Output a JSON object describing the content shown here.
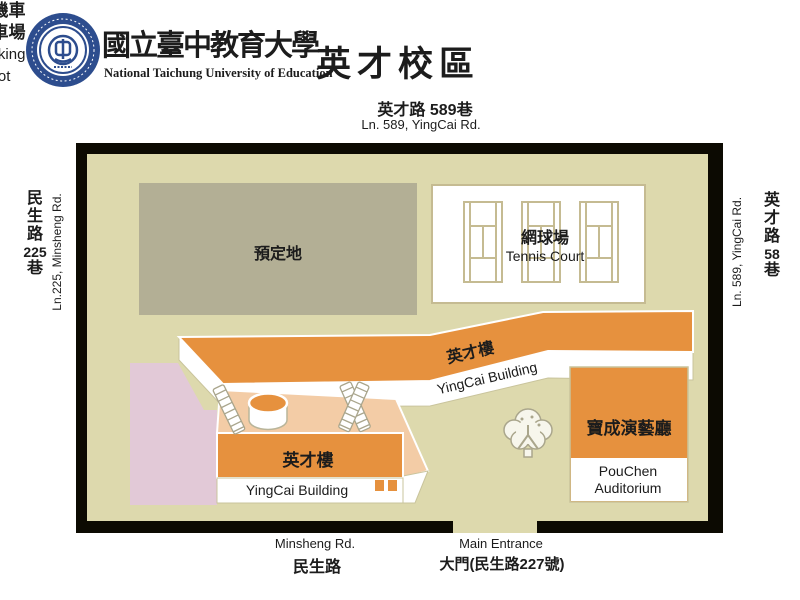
{
  "header": {
    "university_zh": "國立臺中教育大學",
    "university_en": "National Taichung University of Education",
    "campus_title": "英才校區"
  },
  "roads": {
    "top": {
      "zh": "英才路 589巷",
      "en": "Ln. 589, YingCai Rd."
    },
    "left": {
      "parts": [
        "民",
        "生",
        "路",
        "225",
        "巷"
      ],
      "en": "Ln.225, Minsheng Rd."
    },
    "right": {
      "parts": [
        "英",
        "才",
        "路",
        "58",
        "巷"
      ],
      "en": "Ln. 589, YingCai Rd."
    }
  },
  "map": {
    "reserved_site": {
      "label": "預定地"
    },
    "tennis_court": {
      "zh": "網球場",
      "en": "Tennis Court"
    },
    "main_building": {
      "zh": "英才樓",
      "en": "YingCai Building"
    },
    "lower_building": {
      "zh": "英才樓",
      "en": "YingCai Building"
    },
    "parking": {
      "lines": [
        "汽機車",
        "停車場",
        "Parking",
        "Lot"
      ]
    },
    "auditorium": {
      "zh": "寶成演藝廳",
      "en_line1": "PouChen",
      "en_line2": "Auditorium"
    }
  },
  "bottom": {
    "road_en": "Minsheng Rd.",
    "road_zh": "民生路",
    "entrance_en": "Main Entrance",
    "entrance_zh": "大門(民生路227號)"
  },
  "colors": {
    "map_background": "#ddd9ad",
    "frame": "#0c0a02",
    "building_orange": "#e6913e",
    "platform_peach": "#f3cca6",
    "parking_pink": "#e2c9d7",
    "reserved_gray": "#b3af95",
    "court_line_tan": "#c5bb92",
    "seal_blue": "#2d4d8e"
  }
}
